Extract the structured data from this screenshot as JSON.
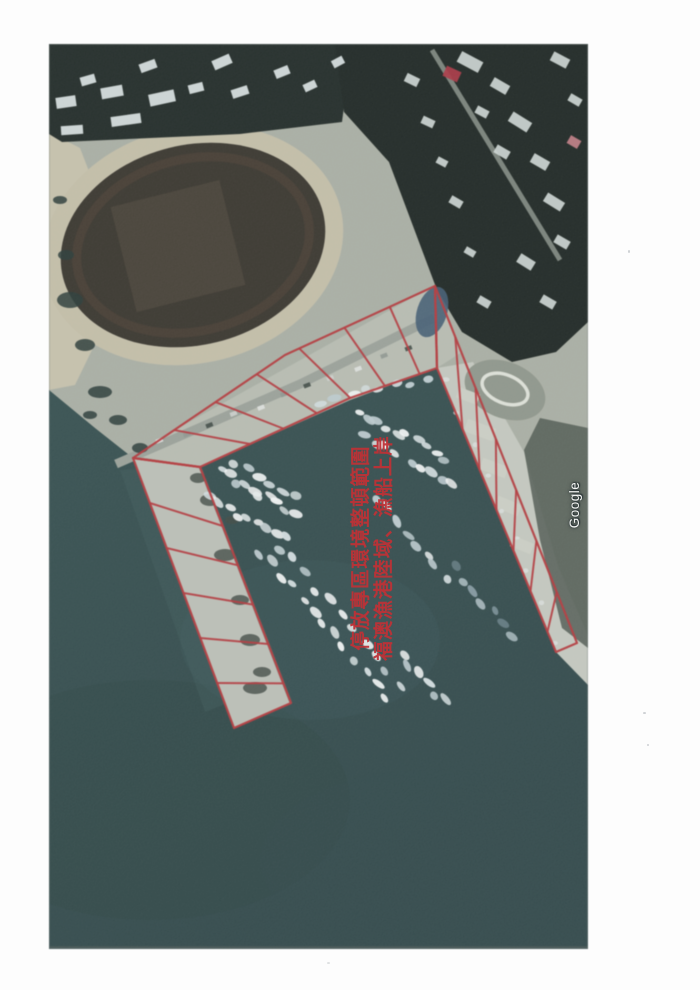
{
  "watermark": {
    "text": "Google"
  },
  "annotation": {
    "lines": [
      "福澳漁港陸域、漁船上岸",
      "停放專區環境整頓範圍"
    ],
    "color": "#bf3136"
  },
  "colors": {
    "page": "#fdfdfd",
    "water": "#2d4a4d",
    "land": "#a9afa3",
    "urban_dark": "#18221e",
    "sand": "#c8c2aa",
    "track": "#c5bfa6",
    "stadium": "#343128",
    "concrete": "#b8bdb1",
    "annotation_red": "#bf3136",
    "roof_red": "#b52f3f"
  }
}
